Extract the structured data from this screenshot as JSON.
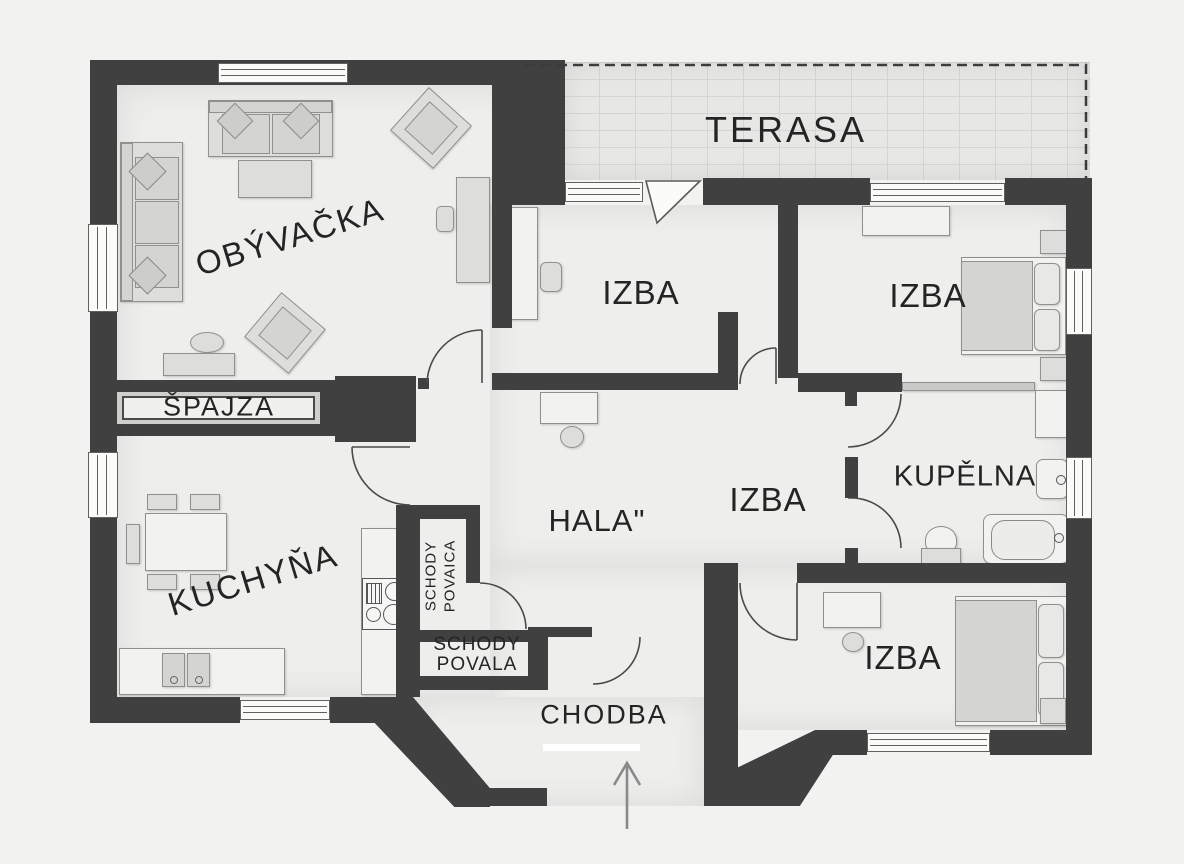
{
  "plan_title": "family-house floor plan",
  "rooms": {
    "obyvacka": "OBÝVAČKA",
    "terasa": "TERASA",
    "izba_top_center": "IZBA",
    "izba_top_right": "IZBA",
    "spajza": "ŠPAJZA",
    "kuchyna": "KUCHYŇA",
    "hala": "HALA\"",
    "izba_middle": "IZBA",
    "kupelna": "KUPĚLNA",
    "izba_bottom": "IZBA",
    "chodba": "CHODBA",
    "schody_vert_line1": "SCHODY",
    "schody_vert_line2": "POVAICA",
    "schody_line1": "SCHODY",
    "schody_line2": "POVALA"
  },
  "icons": {
    "entrance_arrow": "up-arrow marking main entrance"
  },
  "colors": {
    "background": "#f2f2f0",
    "wall": "#404040",
    "floor": "#eeeeec",
    "terrace": "#e7e7e5",
    "furniture": "#dddddb"
  }
}
